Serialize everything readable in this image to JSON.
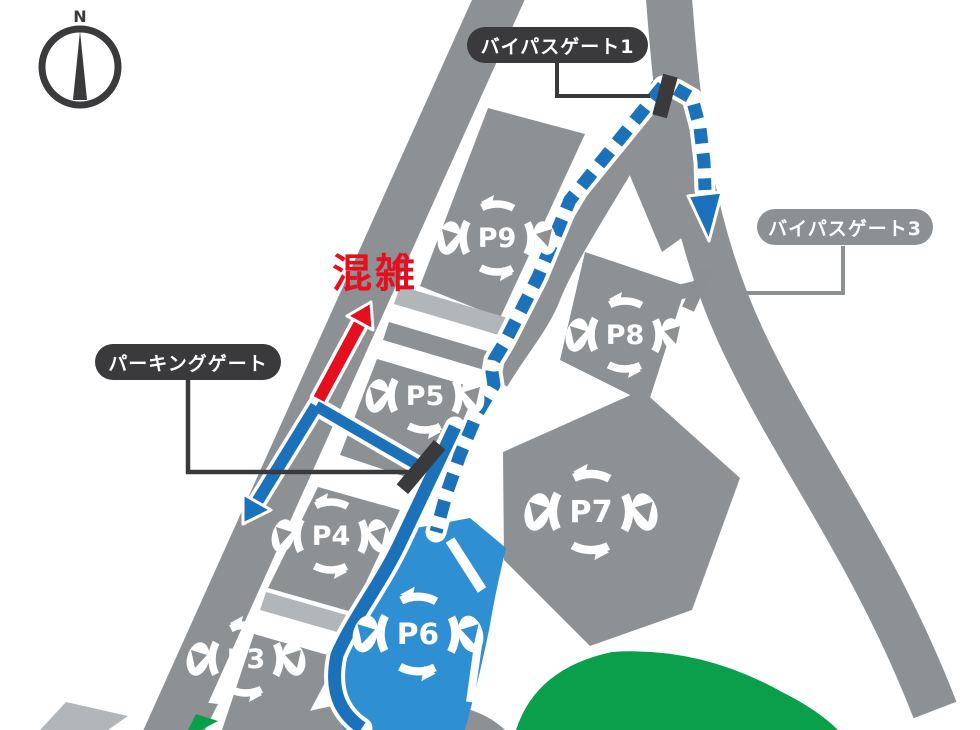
{
  "map": {
    "compass_label": "N",
    "congestion_label": "混雑",
    "gate_labels": {
      "bypass_gate_1": "バイパスゲート1",
      "bypass_gate_3": "バイパスゲート3",
      "parking_gate": "パーキングゲート"
    },
    "lots": [
      {
        "id": "P9",
        "label": "P9",
        "x": 497,
        "y": 238,
        "scale": 1.0,
        "on": "gray"
      },
      {
        "id": "P8",
        "label": "P8",
        "x": 625,
        "y": 335,
        "scale": 1.0,
        "on": "gray"
      },
      {
        "id": "P5",
        "label": "P5",
        "x": 425,
        "y": 396,
        "scale": 1.0,
        "on": "gray"
      },
      {
        "id": "P7",
        "label": "P7",
        "x": 591,
        "y": 512,
        "scale": 1.12,
        "on": "gray"
      },
      {
        "id": "P4",
        "label": "P4",
        "x": 331,
        "y": 536,
        "scale": 1.0,
        "on": "gray"
      },
      {
        "id": "P6",
        "label": "P6",
        "x": 418,
        "y": 634,
        "scale": 1.1,
        "on": "blue"
      },
      {
        "id": "P3",
        "label": "P3",
        "x": 246,
        "y": 659,
        "scale": 1.0,
        "on": "gray"
      }
    ],
    "colors": {
      "road_gray": "#8e9194",
      "light_gray": "#b3b6b8",
      "dark": "#3a3a3c",
      "gray_label": "#8d9093",
      "route_blue": "#1b72ba",
      "lot_blue": "#2e90d2",
      "congestion_red": "#e60f1e",
      "green": "#0aa04b"
    }
  }
}
